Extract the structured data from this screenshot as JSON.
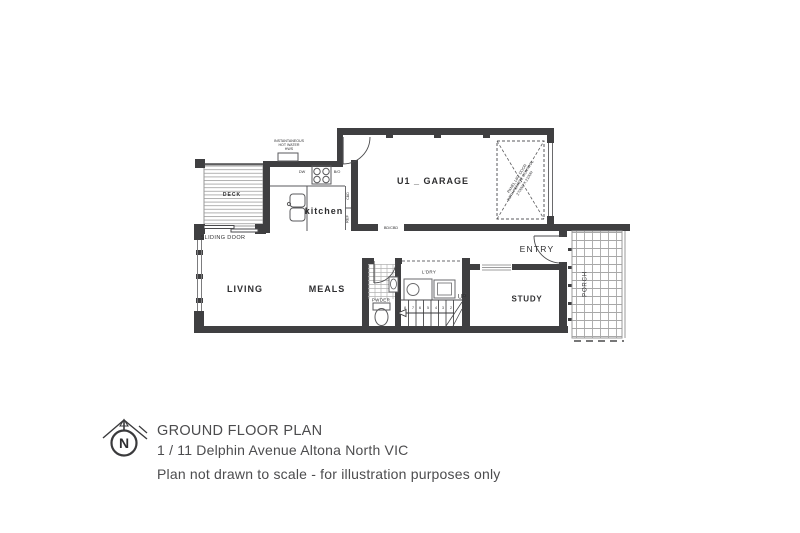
{
  "rooms": {
    "garage": "U1 _ GARAGE",
    "kitchen": "kitchen",
    "living": "LIVING",
    "meals": "MEALS",
    "study": "STUDY",
    "entry": "ENTRY",
    "deck": "DECK",
    "porch": "PORCH",
    "powder": "PWDER",
    "laundry": "L'DRY"
  },
  "annotations": {
    "sliding_door": "SLIDING DOOR",
    "hot_water_line1": "INSTANTANEOUS",
    "hot_water_line2": "HOT WATER",
    "hot_water_line3": "HWS",
    "garage_door_line1": "PANEL LIFT DOOR",
    "garage_door_line2": "WITH REMOTE CONTROL",
    "garage_door_line3": "2700W X 2100H",
    "ref": "REF",
    "cbd": "CBD",
    "bd_cbd": "BD/CBD",
    "dw": "DW",
    "bo": "B/O",
    "up": "UP",
    "stair_numbers": [
      "8",
      "7",
      "6",
      "5",
      "4",
      "3",
      "2"
    ]
  },
  "title_block": {
    "north": "N",
    "title": "GROUND FLOOR PLAN",
    "address": "1 / 11 Delphin Avenue Altona North VIC",
    "disclaimer": "Plan not drawn to scale - for illustration purposes only"
  },
  "colors": {
    "wall": "#3f3f41",
    "line": "#58585a",
    "text": "#2e2e30",
    "title_text": "#4c4c4e",
    "background": "#ffffff"
  }
}
